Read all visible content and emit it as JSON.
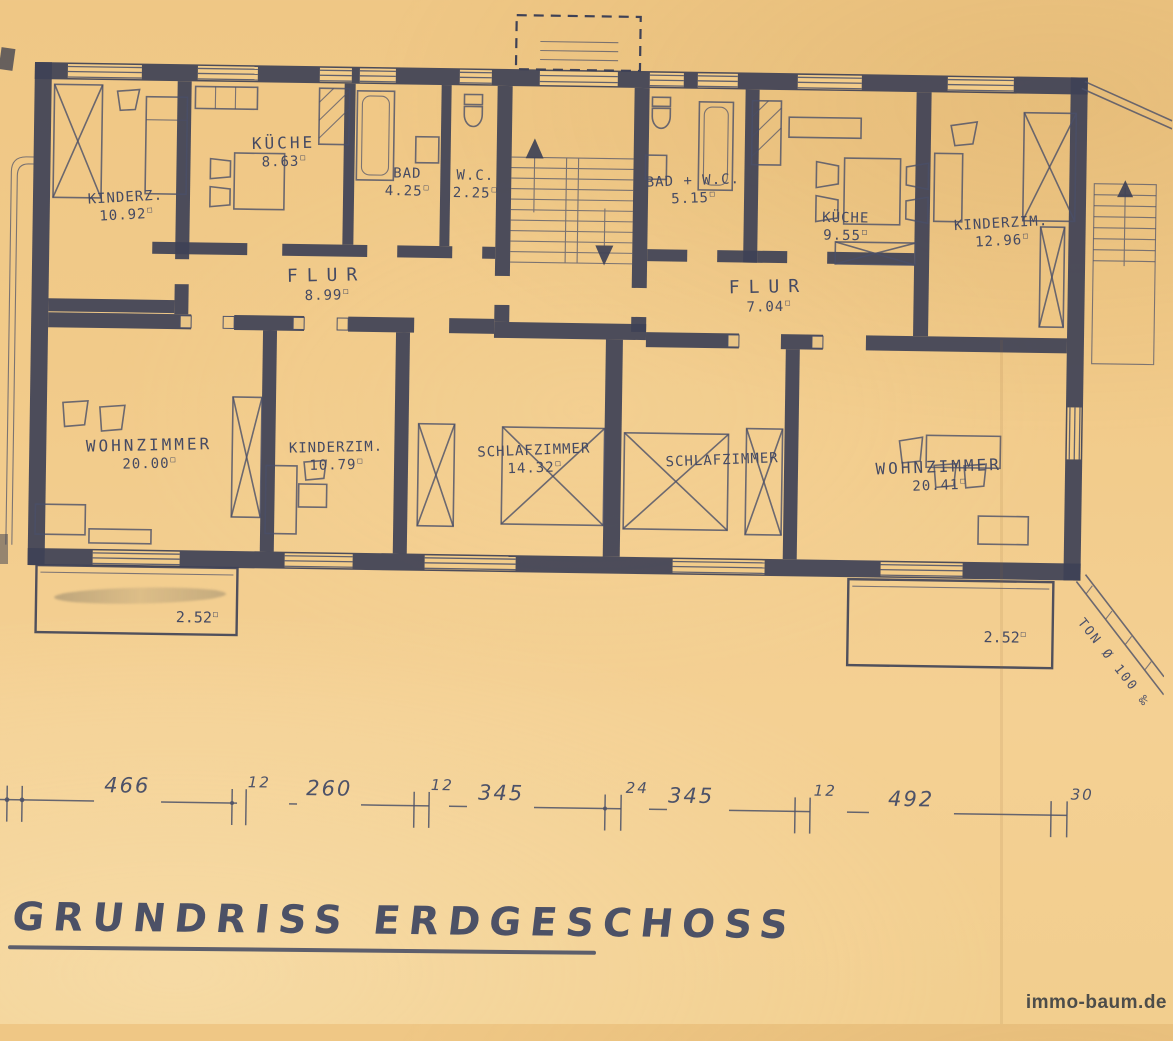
{
  "title": "GRUNDRISS ERDGESCHOSS",
  "watermark": "immo-baum.de",
  "plan": {
    "unit_mark": "□",
    "pipe_label": "TON Ø 100 ‰",
    "rooms": [
      {
        "name": "KINDERZ.",
        "area": "10.92"
      },
      {
        "name": "KÜCHE",
        "area": "8.63"
      },
      {
        "name": "BAD",
        "area": "4.25"
      },
      {
        "name": "W.C.",
        "area": "2.25"
      },
      {
        "name": "FLUR",
        "area": "8.99"
      },
      {
        "name": "BAD + W.C.",
        "area": "5.15"
      },
      {
        "name": "KÜCHE",
        "area": "9.55"
      },
      {
        "name": "KINDERZIM.",
        "area": "12.96"
      },
      {
        "name": "FLUR",
        "area": "7.04"
      },
      {
        "name": "WOHNZIMMER",
        "area": "20.00"
      },
      {
        "name": "KINDERZIM.",
        "area": "10.79"
      },
      {
        "name": "SCHLAFZIMMER",
        "area": "14.32"
      },
      {
        "name": "SCHLAFZIMMER",
        "area": ""
      },
      {
        "name": "WOHNZIMMER",
        "area": "20.41"
      }
    ],
    "balconies": [
      {
        "area": "2.52"
      },
      {
        "area": "2.52"
      }
    ]
  },
  "dims": {
    "leading": "0",
    "values": [
      "466",
      "12",
      "260",
      "12",
      "345",
      "24",
      "345",
      "12",
      "492",
      "30"
    ]
  },
  "colors": {
    "paper": "#f2cc8a",
    "ink": "#3e4156",
    "ink_light": "#4a4f68",
    "text": "#454a63"
  }
}
